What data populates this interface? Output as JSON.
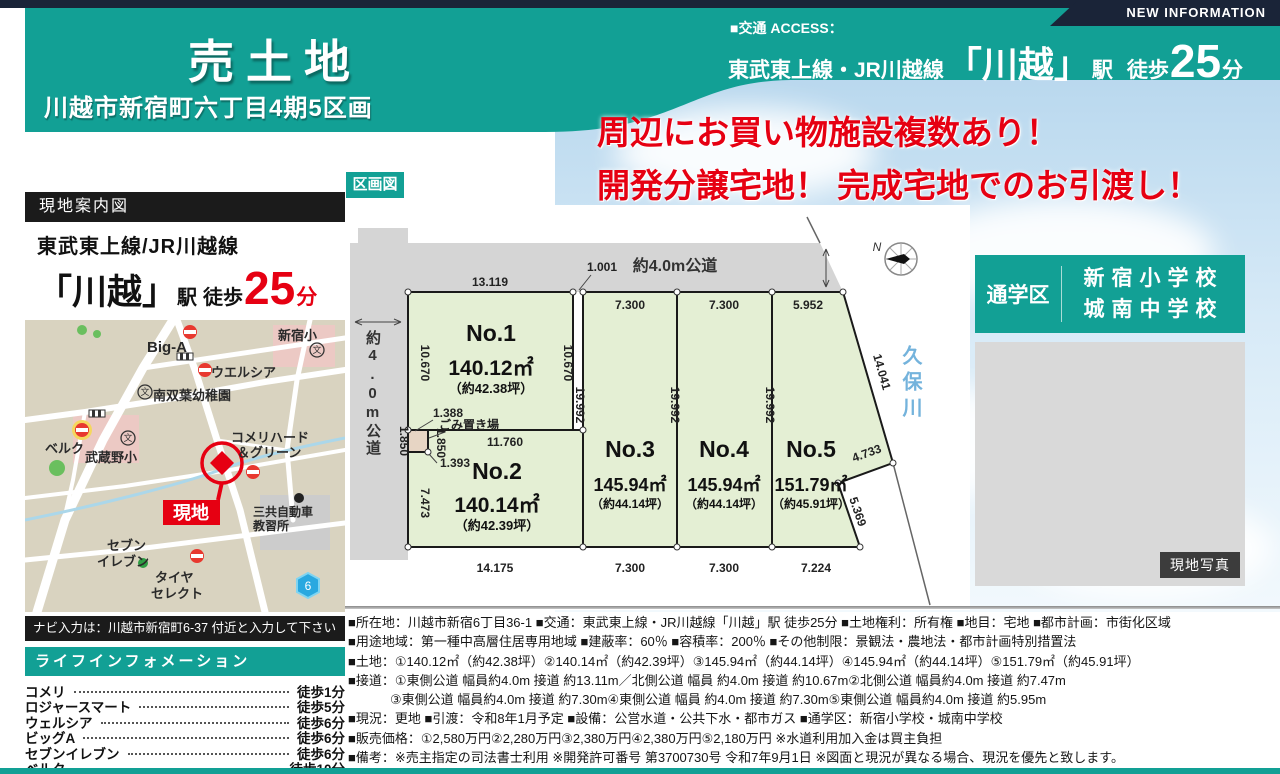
{
  "colors": {
    "teal": "#12a095",
    "navy": "#1a2438",
    "red": "#e60012",
    "lot_green": "#e4efd4",
    "road_gray": "#d5d5d5",
    "map_beige": "#d9d3c0"
  },
  "header": {
    "new_information": "NEW INFORMATION",
    "title": "売土地",
    "subtitle": "川越市新宿町六丁目4期5区画",
    "access_label": "■交通 ACCESS：",
    "rail_lines": "東武東上線・JR川越線",
    "station": "「川越」",
    "station_unit": "駅",
    "walk_label": "徒歩",
    "walk_minutes": "25",
    "minutes_unit": "分"
  },
  "catch_copy": {
    "line1": "周辺にお買い物施設複数あり！",
    "line2": "開発分譲宅地！ 完成宅地でのお引渡し！"
  },
  "plot_map": {
    "label": "区画図",
    "top_road": "約4.0m公道",
    "left_road": "約4.0m公道",
    "river": "久保川",
    "compass_n": "N",
    "garbage": "ごみ置き場",
    "lots": [
      {
        "no": "No.1",
        "area": "140.12㎡",
        "tsubo": "（約42.38坪）"
      },
      {
        "no": "No.2",
        "area": "140.14㎡",
        "tsubo": "（約42.39坪）"
      },
      {
        "no": "No.3",
        "area": "145.94㎡",
        "tsubo": "（約44.14坪）"
      },
      {
        "no": "No.4",
        "area": "145.94㎡",
        "tsubo": "（約44.14坪）"
      },
      {
        "no": "No.5",
        "area": "151.79㎡",
        "tsubo": "（約45.91坪）"
      }
    ],
    "dims": {
      "no1_top": "13.119",
      "gap": "1.001",
      "no1_left": "10.670",
      "no1_right": "10.670",
      "no3_top": "7.300",
      "no4_top": "7.300",
      "no5_top": "5.952",
      "b23": "19.992",
      "b34": "19.992",
      "b45": "19.992",
      "slant_right": "14.041",
      "cut_a": "4.733",
      "cut_b": "5.369",
      "g_top": "1.388",
      "g_left": "1.850",
      "g_right": "1.850",
      "g_diag": "1.393",
      "no2_top": "11.760",
      "no2_left": "7.473",
      "no2_bottom": "14.175",
      "no3_bottom": "7.300",
      "no4_bottom": "7.300",
      "no5_bottom": "7.224"
    }
  },
  "school_zone": {
    "label": "通学区",
    "school1": "新宿小学校",
    "school2": "城南中学校"
  },
  "site_photo_label": "現地写真",
  "guide": {
    "title": "現地案内図",
    "rail": "東武東上線/JR川越線",
    "station": "「川越」",
    "eki": "駅",
    "walk": "徒歩",
    "minutes": "25",
    "unit": "分",
    "nav_note": "ナビ入力は：川越市新宿町6-37 付近と入力して下さい",
    "map": {
      "labels": {
        "biga": "Big-A",
        "welcia": "ウエルシア",
        "shinjuku_sho": "新宿小",
        "minamifutaba": "南双葉幼稚園",
        "belc": "ベルク",
        "musashino_sho": "武蔵野小",
        "komeri1": "コメリハード",
        "komeri2": "＆グリーン",
        "genchi": "現地",
        "sankyo1": "三共自動車",
        "sankyo2": "教習所",
        "seven1": "セブン",
        "seven2": "イレブン",
        "tire1": "タイヤ",
        "tire2": "セレクト",
        "route": "6"
      }
    }
  },
  "life_info": {
    "title": "ライフインフォメーション",
    "items": [
      {
        "name": "コメリ",
        "time": "徒歩1分"
      },
      {
        "name": "ロジャースマート",
        "time": "徒歩5分"
      },
      {
        "name": "ウェルシア",
        "time": "徒歩6分"
      },
      {
        "name": "ビッグA",
        "time": "徒歩6分"
      },
      {
        "name": "セブンイレブン",
        "time": "徒歩6分"
      },
      {
        "name": "ベルク",
        "time": "徒歩10分"
      }
    ]
  },
  "details": {
    "lines": [
      "■所在地：川越市新宿6丁目36-1 ■交通：東武東上線・JR川越線「川越」駅 徒歩25分 ■土地権利：所有権 ■地目：宅地 ■都市計画：市街化区域",
      "■用途地域：第一種中高層住居専用地域 ■建蔽率：60％ ■容積率：200％ ■その他制限：景観法・農地法・都市計画特別措置法",
      "■土地：①140.12㎡（約42.38坪）②140.14㎡（約42.39坪）③145.94㎡（約44.14坪）④145.94㎡（約44.14坪）⑤151.79㎡（約45.91坪）",
      "■接道：①東側公道 幅員約4.0m 接道 約13.11m／北側公道 幅員 約4.0m 接道 約10.67m②北側公道 幅員約4.0m 接道 約7.47m",
      "③東側公道 幅員約4.0m 接道 約7.30m④東側公道 幅員 約4.0m 接道 約7.30m⑤東側公道 幅員約4.0m 接道 約5.95m",
      "■現況：更地 ■引渡：令和8年1月予定 ■設備：公営水道・公共下水・都市ガス ■通学区：新宿小学校・城南中学校",
      "■販売価格：①2,580万円②2,280万円③2,380万円④2,380万円⑤2,180万円 ※水道利用加入金は買主負担",
      "■備考：※売主指定の司法書士利用 ※開発許可番号 第3700730号 令和7年9月1日 ※図面と現況が異なる場合、現況を優先と致します。"
    ]
  }
}
